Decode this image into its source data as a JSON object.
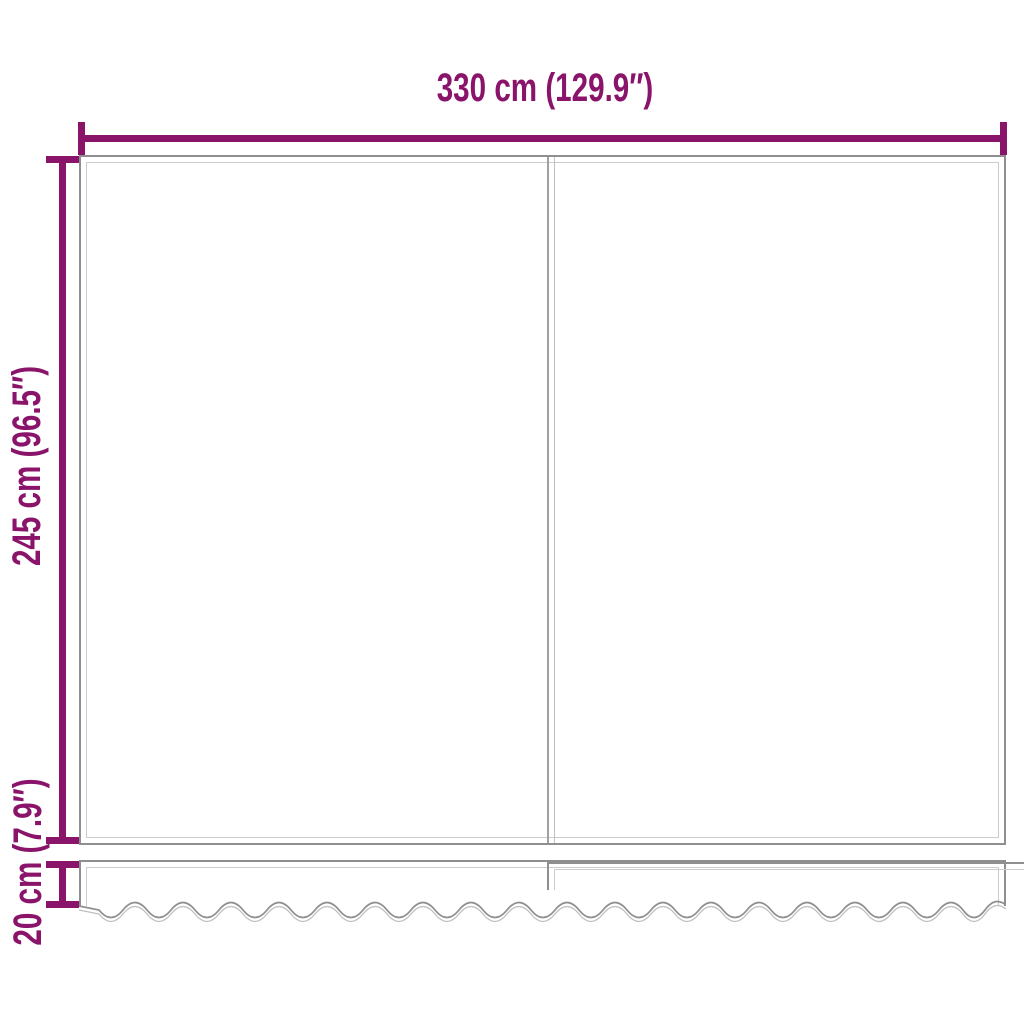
{
  "diagram": {
    "type": "product-dimension-drawing",
    "width_label": "330 cm (129.9″)",
    "height_label": "245 cm (96.5″)",
    "valance_label": "20 cm (7.9″)",
    "width_value_cm": 330,
    "width_value_in": 129.9,
    "height_value_cm": 245,
    "height_value_in": 96.5,
    "valance_value_cm": 20,
    "valance_value_in": 7.9
  },
  "colors": {
    "accent": "#8B146B",
    "outline": "#8f8f8f",
    "inner_line": "#cccccc"
  }
}
